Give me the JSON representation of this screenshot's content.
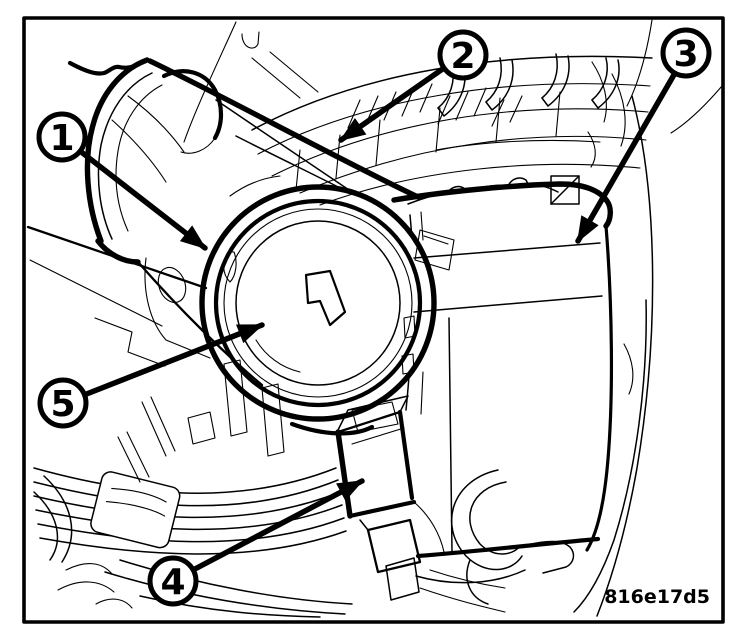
{
  "figure": {
    "id_label": "816e17d5",
    "background_color": "#ffffff",
    "line_color": "#000000"
  },
  "callouts": [
    {
      "number": "1"
    },
    {
      "number": "2"
    },
    {
      "number": "3"
    },
    {
      "number": "4"
    },
    {
      "number": "5"
    }
  ]
}
